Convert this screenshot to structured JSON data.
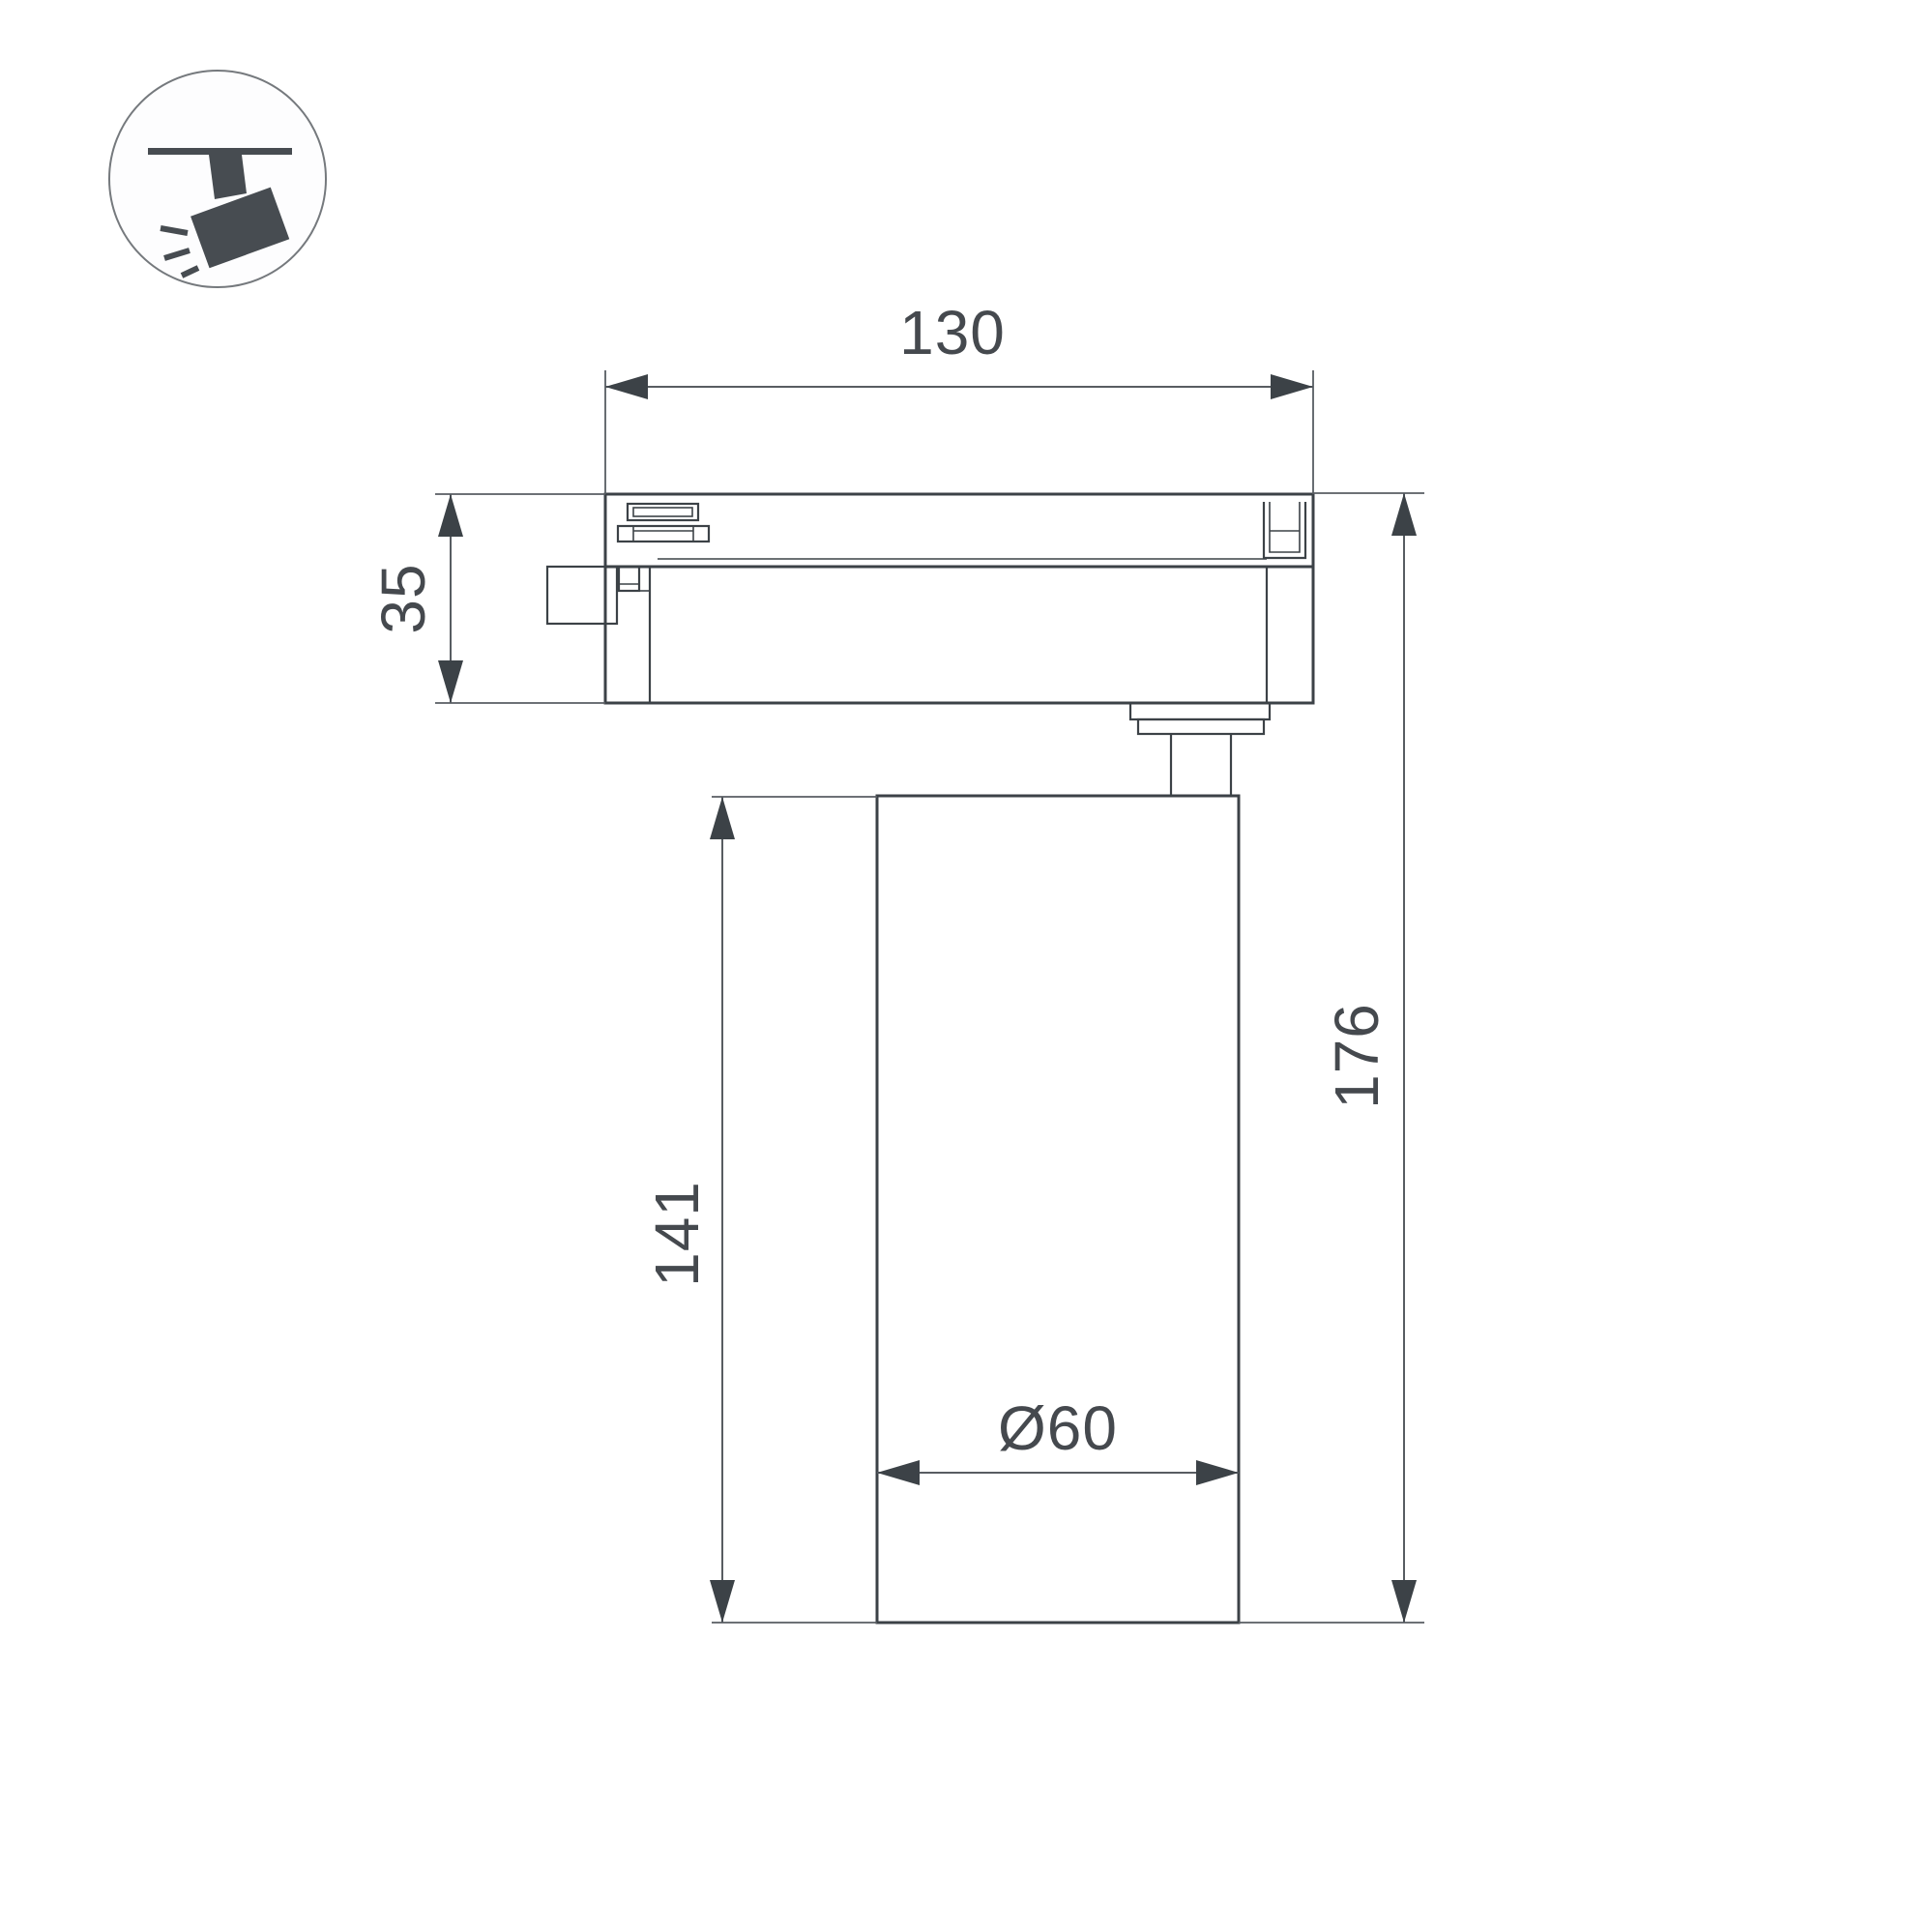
{
  "icons": {
    "badge": "track-spotlight-icon"
  },
  "dimensions": {
    "track_width": "130",
    "adapter_height": "35",
    "body_height": "141",
    "total_height": "176",
    "body_diameter": "Ø60"
  },
  "colors": {
    "line": "#3c4247",
    "dimension": "#585d62",
    "text": "#45494e",
    "icon": "#474c51",
    "circle_stroke": "#75797d",
    "background": "#ffffff"
  }
}
